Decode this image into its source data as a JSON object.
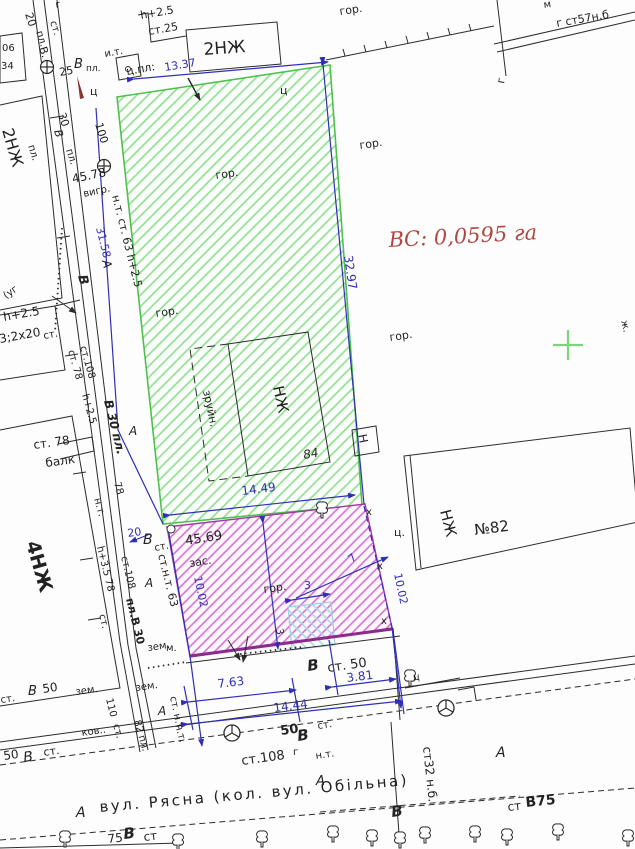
{
  "title": {
    "vc": "ВС: 0,0595 га"
  },
  "street": {
    "name": "вул. Рясна (кол. вул. Обільна)"
  },
  "buildings": {
    "top": "2НЖ",
    "left": "2НЖ",
    "four": "4НЖ",
    "inner": "НЖ",
    "right": "НЖ",
    "num82": "№82",
    "num84": "84",
    "n_box": "Н"
  },
  "dims": {
    "top": "13.37",
    "left1": "31.58",
    "total_left": "45.78",
    "right": "32.97",
    "green_w": "14.49",
    "mag_len": "45.69",
    "mag_h_l": "10.02",
    "mag_h_r": "10.02",
    "f1": "7.63",
    "f2": "3.81",
    "f3": "14.44",
    "s3": "3",
    "s3b": "3",
    "s7": "7",
    "n100": "100",
    "n20a": "20",
    "n20b": "20",
    "n25": "25",
    "n30a": "30",
    "n50a": "50",
    "n50b": "50",
    "n50c": "50",
    "n75": "75",
    "n78": "78",
    "n110": "110"
  },
  "ann": {
    "gor_top": "гор.",
    "gor_ne": "гор.",
    "gor_green1": "гор.",
    "gor_green2": "гор.",
    "gor_green3": "гор.",
    "gor_mag": "гор.",
    "h25_top": "h+2.5",
    "st25_top": "ст.25",
    "it_top": "и.т.",
    "cpl_top": "ц.пл:",
    "m_top": "м",
    "st57": "г ст57н.б",
    "g_right": "г",
    "g_tl": "г",
    "n06": "06",
    "n34": "34",
    "v_tl": "В.",
    "pl_tl": "пл.",
    "st_tl": "ст.",
    "pl_tl2": "пл.",
    "c_tl": "ц",
    "c_mid": "ц",
    "c_right": "ц.",
    "c_tree": "ц",
    "v_pl_b": "В",
    "v_pl_pl": "пл.",
    "v_l1": "В",
    "pl_l1": "пл.",
    "pl_l2": "пл.",
    "ntst63": "н.т. ст. 63 h+2.5",
    "a_l1": "А",
    "v_l2": "В",
    "ug": "(уг",
    "h25_l": "h+2.5",
    "x2x20": "3;2x20",
    "st_l3": "ст.",
    "st78_a": "ст. 78",
    "st108_a": "ст.108",
    "h25_l2": "h+2.5",
    "v30pl": "В 30 пл.",
    "a_l2": "А",
    "st78_b": "ст. 78",
    "balk": "балк",
    "nt_l": "н.т.",
    "h35": "h+3.5 78",
    "st_l4": "ст.",
    "v_m1": "В",
    "st_m1": "ст.",
    "stnt63": "ст.н.т. 63",
    "a_m1": "А",
    "st108_b": "ст.108",
    "plv30": "пл.В 30",
    "zem_m": "зем.",
    "zem_s1": "зем.",
    "zem_s2": "зем.",
    "st_s1": "ст.",
    "v_s1": "В",
    "a_s1": "А",
    "kov": "ков..",
    "st_s2": "ст.",
    "pl82": "82 пл.",
    "nt_s1": "н.т.",
    "m_dot": "м.",
    "stnt_v": "ст. н.т",
    "v_front": "В",
    "st50_front": "ст. 50",
    "v_s2": "В",
    "g_s": "г",
    "st108_s": "ст.108",
    "nt_s2": "н.т.",
    "st_s3": "ст.",
    "a_street1": "А",
    "a_street2": "А",
    "a_s2": "А",
    "v_s3": "В",
    "st_s4": "ст",
    "v_s4": "В",
    "v_s5": "В",
    "st_s5": "ст.",
    "st32nb": "ст32 н.б.",
    "stv75_st": "ст",
    "stv75_v": "В75",
    "zh_right": "ж.",
    "zas": "зас.",
    "x1": "х",
    "x2": "х",
    "x3": "х",
    "vygr": "вигр.",
    "zruyn": "зруйн."
  },
  "icons": {
    "benchmark": "circle-plus-survey-mark",
    "well": "circle-tripod-utility",
    "tree": "deciduous-tree",
    "grid_cross": "coordinate-grid-cross"
  },
  "colors": {
    "boundary_blue": "#2f2fb5",
    "parcel_green": "#4ec04e",
    "parcel_magenta": "#a238a2",
    "highlight_red": "#b04742",
    "inner_cyan": "#9fcfe0"
  }
}
